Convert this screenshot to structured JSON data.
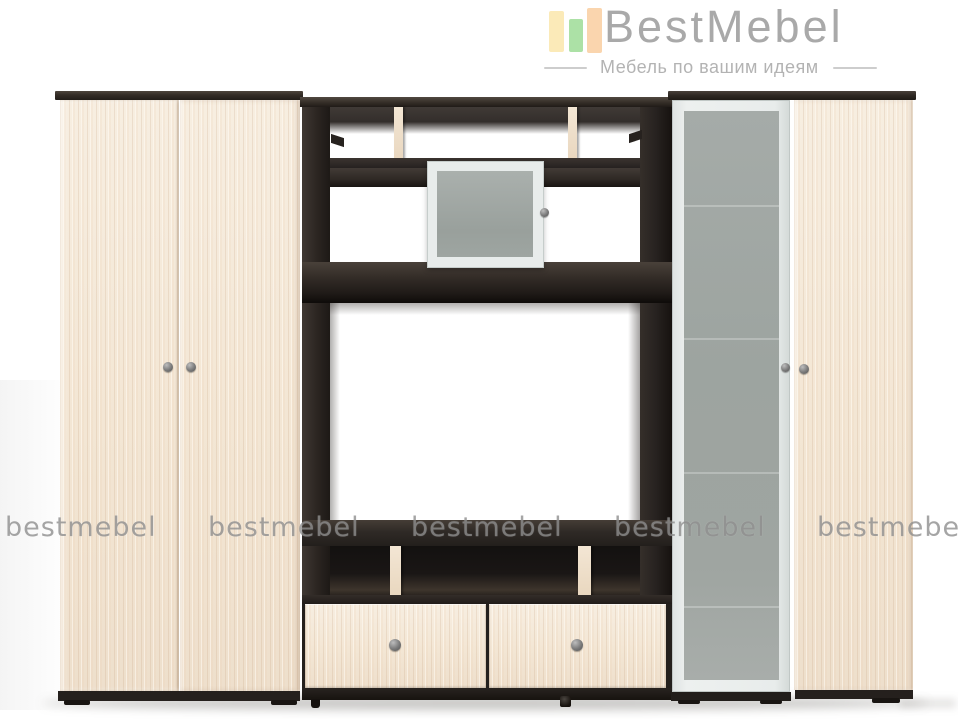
{
  "header": {
    "brand": "BestMebel",
    "tagline": "Мебель по вашим идеям"
  },
  "watermark": {
    "text": "bestmebel"
  },
  "colors": {
    "logo-bar-yellow": "#fbeab8",
    "logo-bar-green": "#ace1a6",
    "logo-bar-orange": "#fad5ae",
    "logo-text": "#a9a9a9",
    "tagline-text": "#b3b3b3",
    "watermark": "#8f8f8f",
    "wood-light": "#f4e8d7",
    "wenge-dark": "#2c2622",
    "glass-gray": "#9da4a0",
    "frame-white": "#e8eceb",
    "knob-gray": "#7a7a7a"
  }
}
